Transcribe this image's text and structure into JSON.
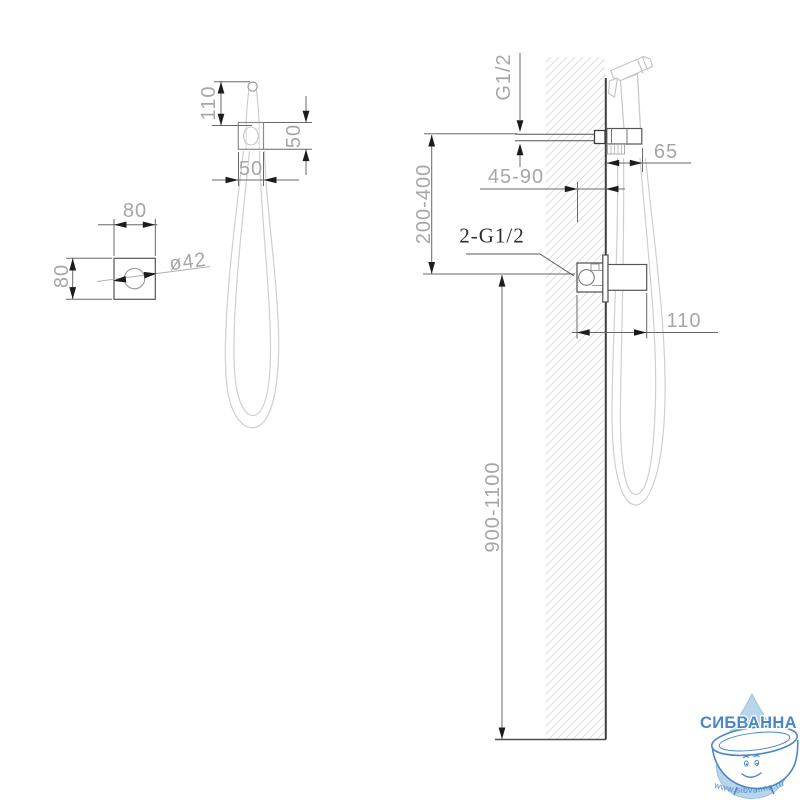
{
  "drawing": {
    "holder_view": {
      "height": "110",
      "side_depth": "50",
      "width": "50"
    },
    "plate_view": {
      "width": "80",
      "height": "80",
      "diameter": "ø42"
    },
    "install_view": {
      "inlet_thread": "G1/2",
      "wall_offset_range": "45-90",
      "conceal_depth_range": "200-400",
      "connections": "2-G1/2",
      "holder_offset": "65",
      "valve_width": "110",
      "mount_height_range": "900-1100"
    }
  },
  "watermark": {
    "brand": "СИБВАННА",
    "url": "www.sibvanna.ru"
  },
  "colors": {
    "dim_line": "#686868",
    "dim_text": "#a6a6a6",
    "hardware": "#4d4d4d",
    "product_silhouette": "#c6c6c6",
    "wall_hatch": "#dedede",
    "watermark_blue": "#4a86c8",
    "watermark_drop": "#b9d5ec"
  }
}
